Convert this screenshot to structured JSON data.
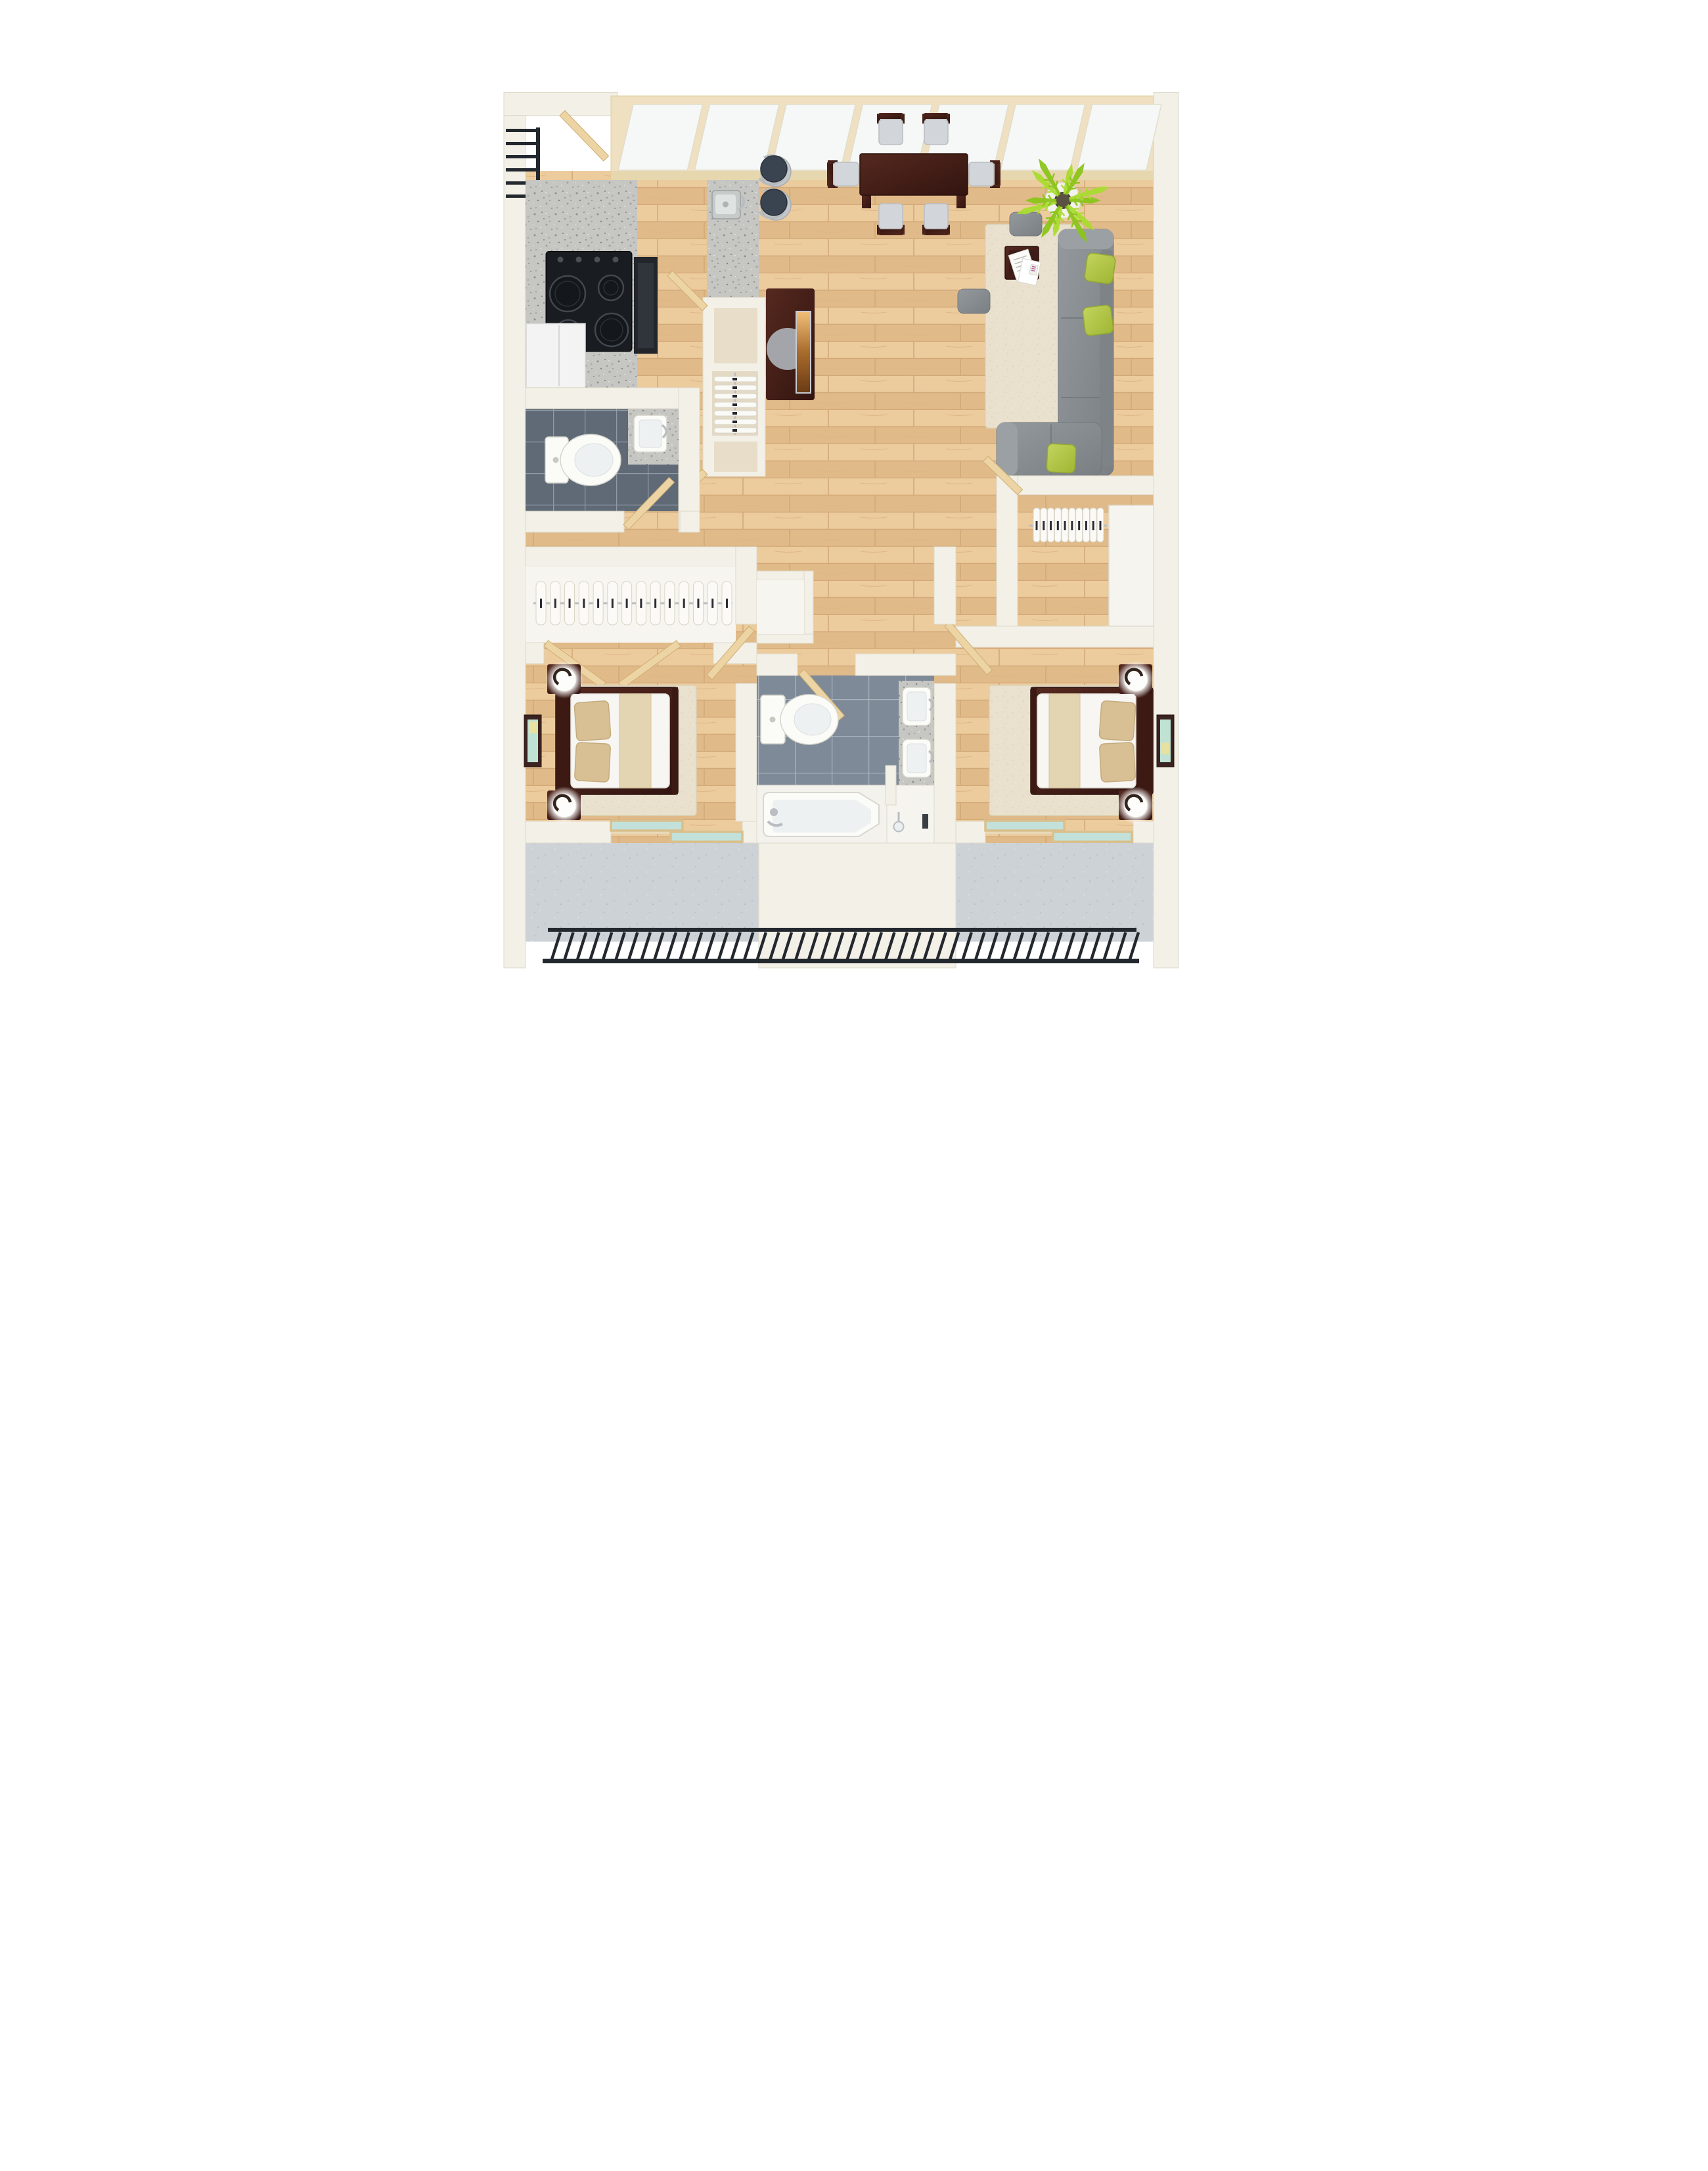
{
  "meta": {
    "title": "2 Bedroom 2 Bath Apartment - 3D Top-Down Floor Plan Render",
    "view": "top-down 3d render",
    "background": "#ffffff"
  },
  "colors": {
    "wall": "#f3f0e7",
    "wall_edge": "#ded9c9",
    "wood_floor": "#e7c494",
    "wood_plank_line": "#d2a877",
    "wood_plank_alt": "#e0ba88",
    "granite": "#c6c6c3",
    "granite_speck_dark": "#8e8e8a",
    "granite_speck_light": "#e4e4e0",
    "half_bath_tile": "#5f6a76",
    "half_bath_grout": "#8f9aa6",
    "bath_tile": "#7e8a97",
    "bath_grout": "#a9b4bf",
    "balcony_concrete": "#cdd2d7",
    "concrete_speck": "#b7bec6",
    "railing_black": "#23272e",
    "door_wood": "#ecd4a4",
    "door_edge": "#cfae72",
    "dark_wood_light": "#55291f",
    "dark_wood_deep": "#331410",
    "sofa_gray_light": "#94999d",
    "sofa_gray_deep": "#7a7f83",
    "pillow_green_light": "#c3d45e",
    "pillow_green_deep": "#9fb633",
    "rug_cream": "#e9e1cd",
    "plant_green_light": "#aadc30",
    "plant_green_deep": "#8cc51b",
    "bed_linen_white": "#f7f6f2",
    "bed_pillow_tan": "#d8c094",
    "bed_runner_tan": "#e4d5b2",
    "window_glass": "#f5f8f6",
    "window_frame": "#eee0c0",
    "window_mullion": "#e0cda4",
    "slider_glass_teal": "#c2e1da",
    "chair_cushion": "#d2d6da",
    "stool_seat": "#3a4350",
    "tv_screen_warm": "#f2c079",
    "chrome": "#b9bdc1",
    "art_teal": "#bfe2d4"
  },
  "scene": {
    "entry": {
      "railing_bar_count": 6,
      "items": [
        "entry-door",
        "landing-railing"
      ]
    },
    "windows": {
      "pane_count": 7,
      "style": "slanted clerestory band along top wall"
    },
    "kitchen": {
      "cooktop": {
        "burner_count": 4,
        "knob_count": 4,
        "color": "black"
      },
      "oven": "built-in dark oven beside cooktop",
      "fridge": "white top-view refrigerator",
      "counter": "granite run along left wall",
      "peninsula": {
        "sink": "stainless single-bowl with faucet",
        "plate_rack": {
          "plate_count": 7
        }
      }
    },
    "dining": {
      "table": "dark mahogany rectangular table",
      "chair_count": 6,
      "stool_count": 2,
      "chair_cushion_color": "light gray"
    },
    "living_room": {
      "sofa": "gray L-shaped sectional against right wall",
      "green_pillow_count": 3,
      "ottoman_count": 2,
      "coffee_table": "dark wood with scattered papers",
      "rug": "cream shag",
      "plant": {
        "type": "potted palm",
        "frond_count": 12,
        "pot": "white round planter"
      },
      "tv": "flat screen on dark media console facing sofa"
    },
    "half_bath": {
      "fixtures": [
        "toilet",
        "vanity sink with granite top"
      ],
      "floor": "dark gray tile"
    },
    "closets": {
      "hall_closet": {
        "hanger_count": 14,
        "doors": "double swing doors"
      },
      "walk_in_closet": {
        "hanger_count": 10,
        "shelf": "white counter shelf on right"
      }
    },
    "bathroom": {
      "fixtures": [
        "toilet",
        "double vanity with 2 sinks",
        "bathtub",
        "shower"
      ],
      "sink_count": 2,
      "floor": "gray tile"
    },
    "bedroom_1": {
      "bed": "queen, dark frame, headboard left",
      "pillow_count": 2,
      "nightstand_count": 2,
      "lamp_count": 2,
      "art": "framed teal print on left wall",
      "rug": "cream shag"
    },
    "bedroom_2": {
      "bed": "queen, dark frame, headboard right",
      "pillow_count": 2,
      "nightstand_count": 2,
      "lamp_count": 2,
      "art": "framed teal print on right wall",
      "rug": "cream shag"
    },
    "balcony": {
      "railing_bar_count": 46,
      "floor": "speckled concrete",
      "sliding_door_count": 2
    }
  }
}
